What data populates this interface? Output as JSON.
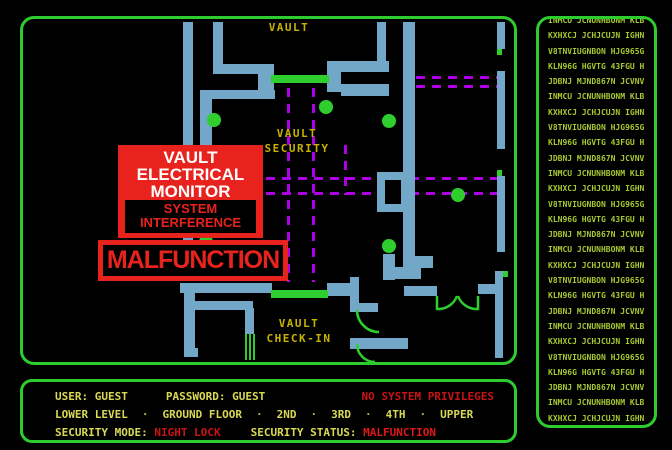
{
  "colors": {
    "background": "#000000",
    "border_green": "#2ECC2E",
    "wall_blue": "#72A7C7",
    "bright_green": "#2FCE2F",
    "path_purple": "#AE00E6",
    "map_label_yellow": "#C6B300",
    "status_yellow": "#D9D955",
    "alert_red": "#E8231D",
    "status_red": "#C81414",
    "terminal_green": "#A8C832"
  },
  "alerts": {
    "monitor_lines": [
      "VAULT",
      "ELECTRICAL",
      "MONITOR"
    ],
    "interference_lines": [
      "SYSTEM",
      "INTERFERENCE"
    ],
    "malfunction": "MALFUNCTION"
  },
  "status": {
    "user_label": "USER:",
    "user_value": "GUEST",
    "password_label": "PASSWORD:",
    "password_value": "GUEST",
    "privileges": "NO SYSTEM PRIVILEGES",
    "floors": [
      "LOWER LEVEL",
      "GROUND FLOOR",
      "2ND",
      "3RD",
      "4TH",
      "UPPER"
    ],
    "floor_separator": "·",
    "mode_label": "SECURITY MODE:",
    "mode_value": "NIGHT LOCK",
    "status_label": "SECURITY STATUS:",
    "status_value": "MALFUNCTION"
  },
  "terminal": {
    "lines": [
      "INMCU JCNUNHBONM KLB",
      "KXHXCJ JCHJCUJN IGHN",
      "V8TNVIUGNBON HJG965G",
      "KLN96G HGVTG 43FGU H",
      "JDBNJ MJND867N JCVNV",
      "INMCU JCNUNHBONM KLB",
      "KXHXCJ JCHJCUJN IGHN",
      "V8TNVIUGNBON HJG965G",
      "KLN96G HGVTG 43FGU H",
      "JDBNJ MJND867N JCVNV",
      "INMCU JCNUNHBONM KLB",
      "KXHXCJ JCHJCUJN IGHN",
      "V8TNVIUGNBON HJG965G",
      "KLN96G HGVTG 43FGU H",
      "JDBNJ MJND867N JCVNV",
      "INMCU JCNUNHBONM KLB",
      "KXHXCJ JCHJCUJN IGHN",
      "V8TNVIUGNBON HJG965G",
      "KLN96G HGVTG 43FGU H",
      "JDBNJ MJND867N JCVNV",
      "INMCU JCNUNHBONM KLB",
      "KXHXCJ JCHJCUJN IGHN",
      "V8TNVIUGNBON HJG965G",
      "KLN96G HGVTG 43FGU H",
      "JDBNJ MJND867N JCVNV",
      "INMCU JCNUNHBONM KLB",
      "KXHXCJ JCHJCUJN IGHN"
    ]
  },
  "map": {
    "labels": [
      {
        "text": "VAULT",
        "x": 267,
        "y": 13
      },
      {
        "text": "VAULT",
        "x": 275,
        "y": 119
      },
      {
        "text": "SECURITY",
        "x": 275,
        "y": 134
      },
      {
        "text": "VAULT",
        "x": 277,
        "y": 309
      },
      {
        "text": "CHECK-IN",
        "x": 277,
        "y": 324
      }
    ],
    "walls": [
      [
        161,
        4,
        10,
        221
      ],
      [
        191,
        4,
        10,
        46
      ],
      [
        191,
        46,
        55,
        10
      ],
      [
        236,
        46,
        16,
        26
      ],
      [
        305,
        43,
        14,
        31
      ],
      [
        319,
        43,
        48,
        11
      ],
      [
        319,
        66,
        48,
        12
      ],
      [
        188,
        72,
        65,
        9
      ],
      [
        178,
        72,
        12,
        153
      ],
      [
        355,
        4,
        9,
        50
      ],
      [
        381,
        4,
        12,
        246
      ],
      [
        355,
        154,
        26,
        40
      ],
      [
        393,
        238,
        18,
        12
      ],
      [
        475,
        4,
        8,
        27
      ],
      [
        475,
        53,
        8,
        78
      ],
      [
        475,
        158,
        8,
        76
      ],
      [
        473,
        253,
        8,
        87
      ],
      [
        158,
        265,
        92,
        10
      ],
      [
        305,
        265,
        24,
        13
      ],
      [
        162,
        272,
        11,
        67
      ],
      [
        173,
        283,
        58,
        9
      ],
      [
        223,
        290,
        9,
        26
      ],
      [
        162,
        330,
        14,
        9
      ],
      [
        361,
        236,
        12,
        26
      ],
      [
        373,
        249,
        26,
        12
      ],
      [
        382,
        268,
        33,
        10
      ],
      [
        456,
        266,
        20,
        10
      ],
      [
        328,
        320,
        58,
        11
      ],
      [
        328,
        285,
        28,
        9
      ],
      [
        328,
        259,
        9,
        28
      ]
    ],
    "holes": [
      [
        363,
        162,
        16,
        24
      ]
    ],
    "green_rects": [
      [
        249,
        57,
        58,
        8
      ],
      [
        249,
        272,
        57,
        8
      ],
      [
        475,
        31,
        5,
        6
      ],
      [
        475,
        152,
        5,
        6
      ],
      [
        481,
        253,
        5,
        6
      ],
      [
        223,
        316,
        2,
        26
      ],
      [
        227,
        316,
        2,
        26
      ],
      [
        231,
        316,
        2,
        26
      ]
    ],
    "dots": [
      [
        192,
        102
      ],
      [
        304,
        89
      ],
      [
        367,
        103
      ],
      [
        436,
        177
      ],
      [
        367,
        228
      ],
      [
        184,
        224
      ]
    ],
    "dashes": [
      [
        266.5,
        70,
        266.5,
        264
      ],
      [
        291.5,
        70,
        291.5,
        264
      ],
      [
        244,
        160.5,
        475,
        160.5
      ],
      [
        244,
        175.5,
        475,
        175.5
      ],
      [
        394,
        59.5,
        475,
        59.5
      ],
      [
        394,
        68.5,
        475,
        68.5
      ],
      [
        323.5,
        127,
        323.5,
        177
      ]
    ],
    "arcs": [
      "M 415 278 L 415 291 A 20 20 0 0 0 435 278",
      "M 456 278 L 456 291 A 20 20 0 0 1 436 278",
      "M 335 292 A 22 22 0 0 0 357 314",
      "M 335 326 A 18 18 0 0 0 353 344"
    ]
  }
}
